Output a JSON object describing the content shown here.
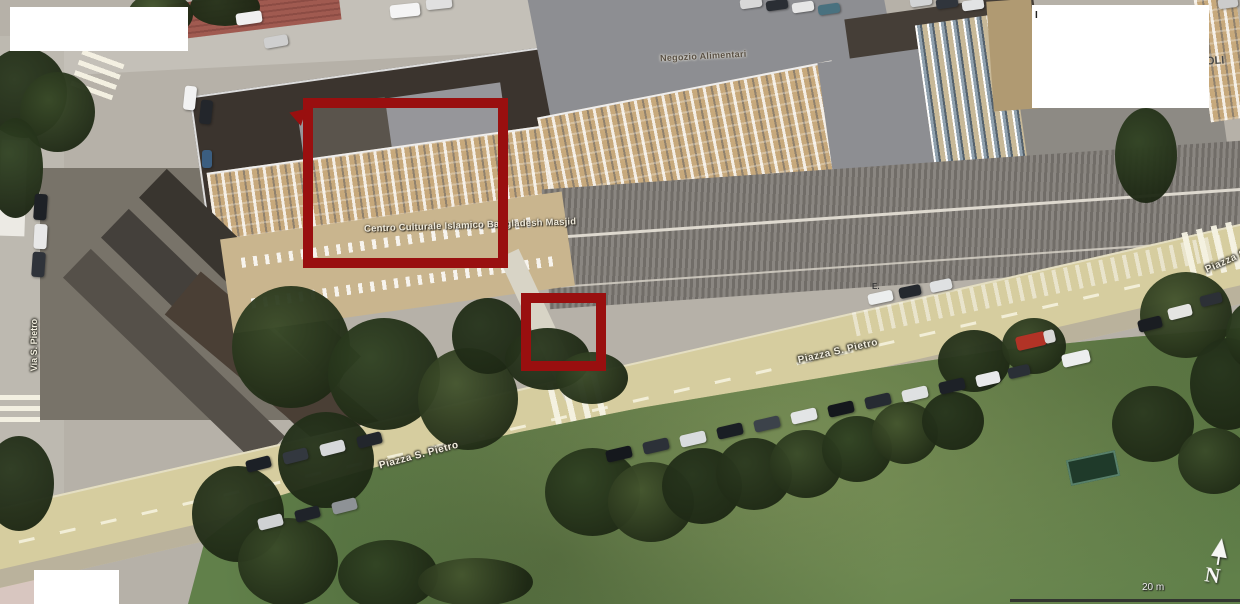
{
  "map": {
    "poi_labels": {
      "shop": "Negozio Alimentari",
      "mosque": "Centro Culturale Islamico Bangladesh Masjid"
    },
    "street_labels": {
      "main_road_a": "Piazza S. Pietro",
      "main_road_b": "Piazza S. Pietro",
      "right_edge_clipped": "Piazza S",
      "left_road": "Via S. Pietro"
    },
    "text_fragments": {
      "right_edge": "OLI",
      "top_edge": "I",
      "center": "E."
    },
    "compass_letter": "N",
    "scale_text": "20 m",
    "colors": {
      "annotation_red": "#990f0f",
      "redaction_white": "#ffffff",
      "road_yellow": "#d6cd9f",
      "grass_green": "#61804a",
      "tree_dark_green": "#2e3d22",
      "roof_dark": "#3b342e",
      "roof_gray": "#8d8e92",
      "facade_tan": "#c7a97c"
    }
  }
}
